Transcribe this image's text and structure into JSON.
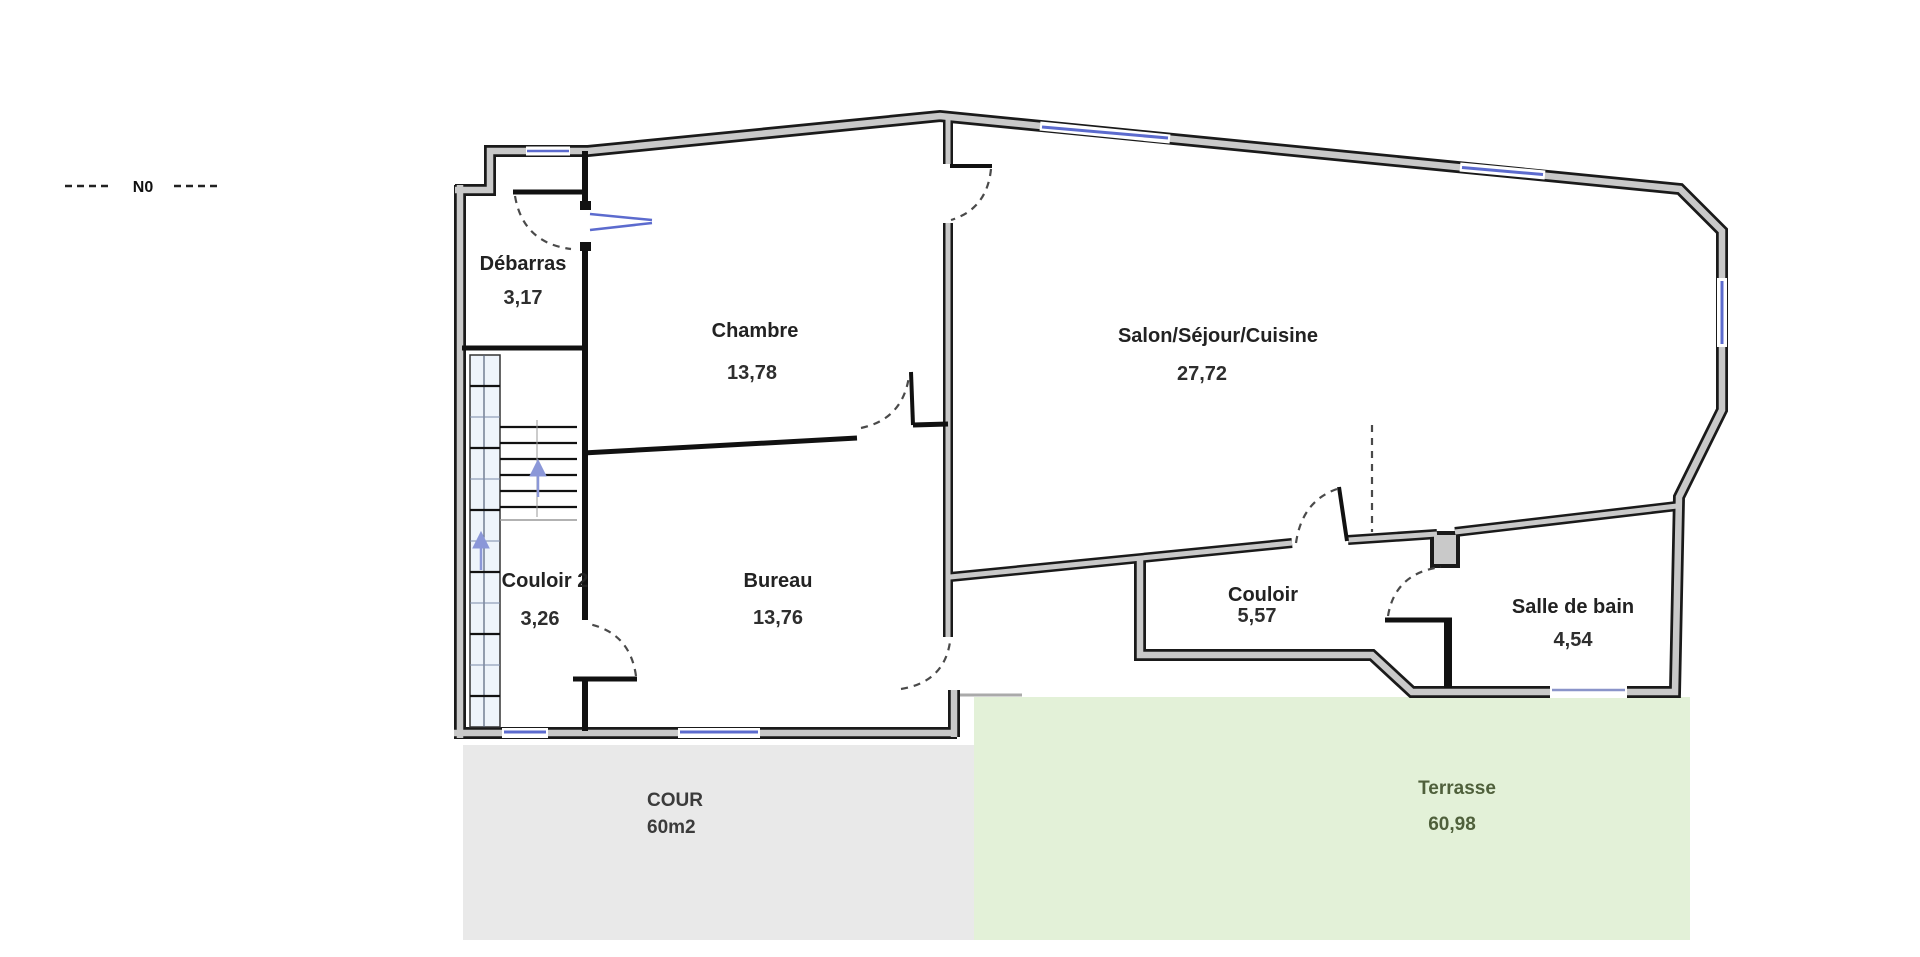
{
  "legend": {
    "north_label": "N0"
  },
  "rooms": [
    {
      "name": "Débarras",
      "area": "3,17"
    },
    {
      "name": "Chambre",
      "area": "13,78"
    },
    {
      "name": "Salon/Séjour/Cuisine",
      "area": "27,72"
    },
    {
      "name": "Couloir 2",
      "area": "3,26"
    },
    {
      "name": "Bureau",
      "area": "13,76"
    },
    {
      "name": "Couloir",
      "area": "5,57"
    },
    {
      "name": "Salle de bain",
      "area": "4,54"
    }
  ],
  "outdoor": {
    "cour": {
      "name": "COUR",
      "area": "60m2"
    },
    "terrasse": {
      "name": "Terrasse",
      "area": "60,98"
    }
  },
  "colors": {
    "wall_fill": "#c9c9c9",
    "wall_edge": "#1a1a1a",
    "cour_background": "#e9e9e9",
    "terrasse_background": "#e3f1d8",
    "terrasse_text": "#4f603b",
    "window_blue": "#5c6bce",
    "stair_arrow": "#8b97d8",
    "label_text": "#222222"
  }
}
